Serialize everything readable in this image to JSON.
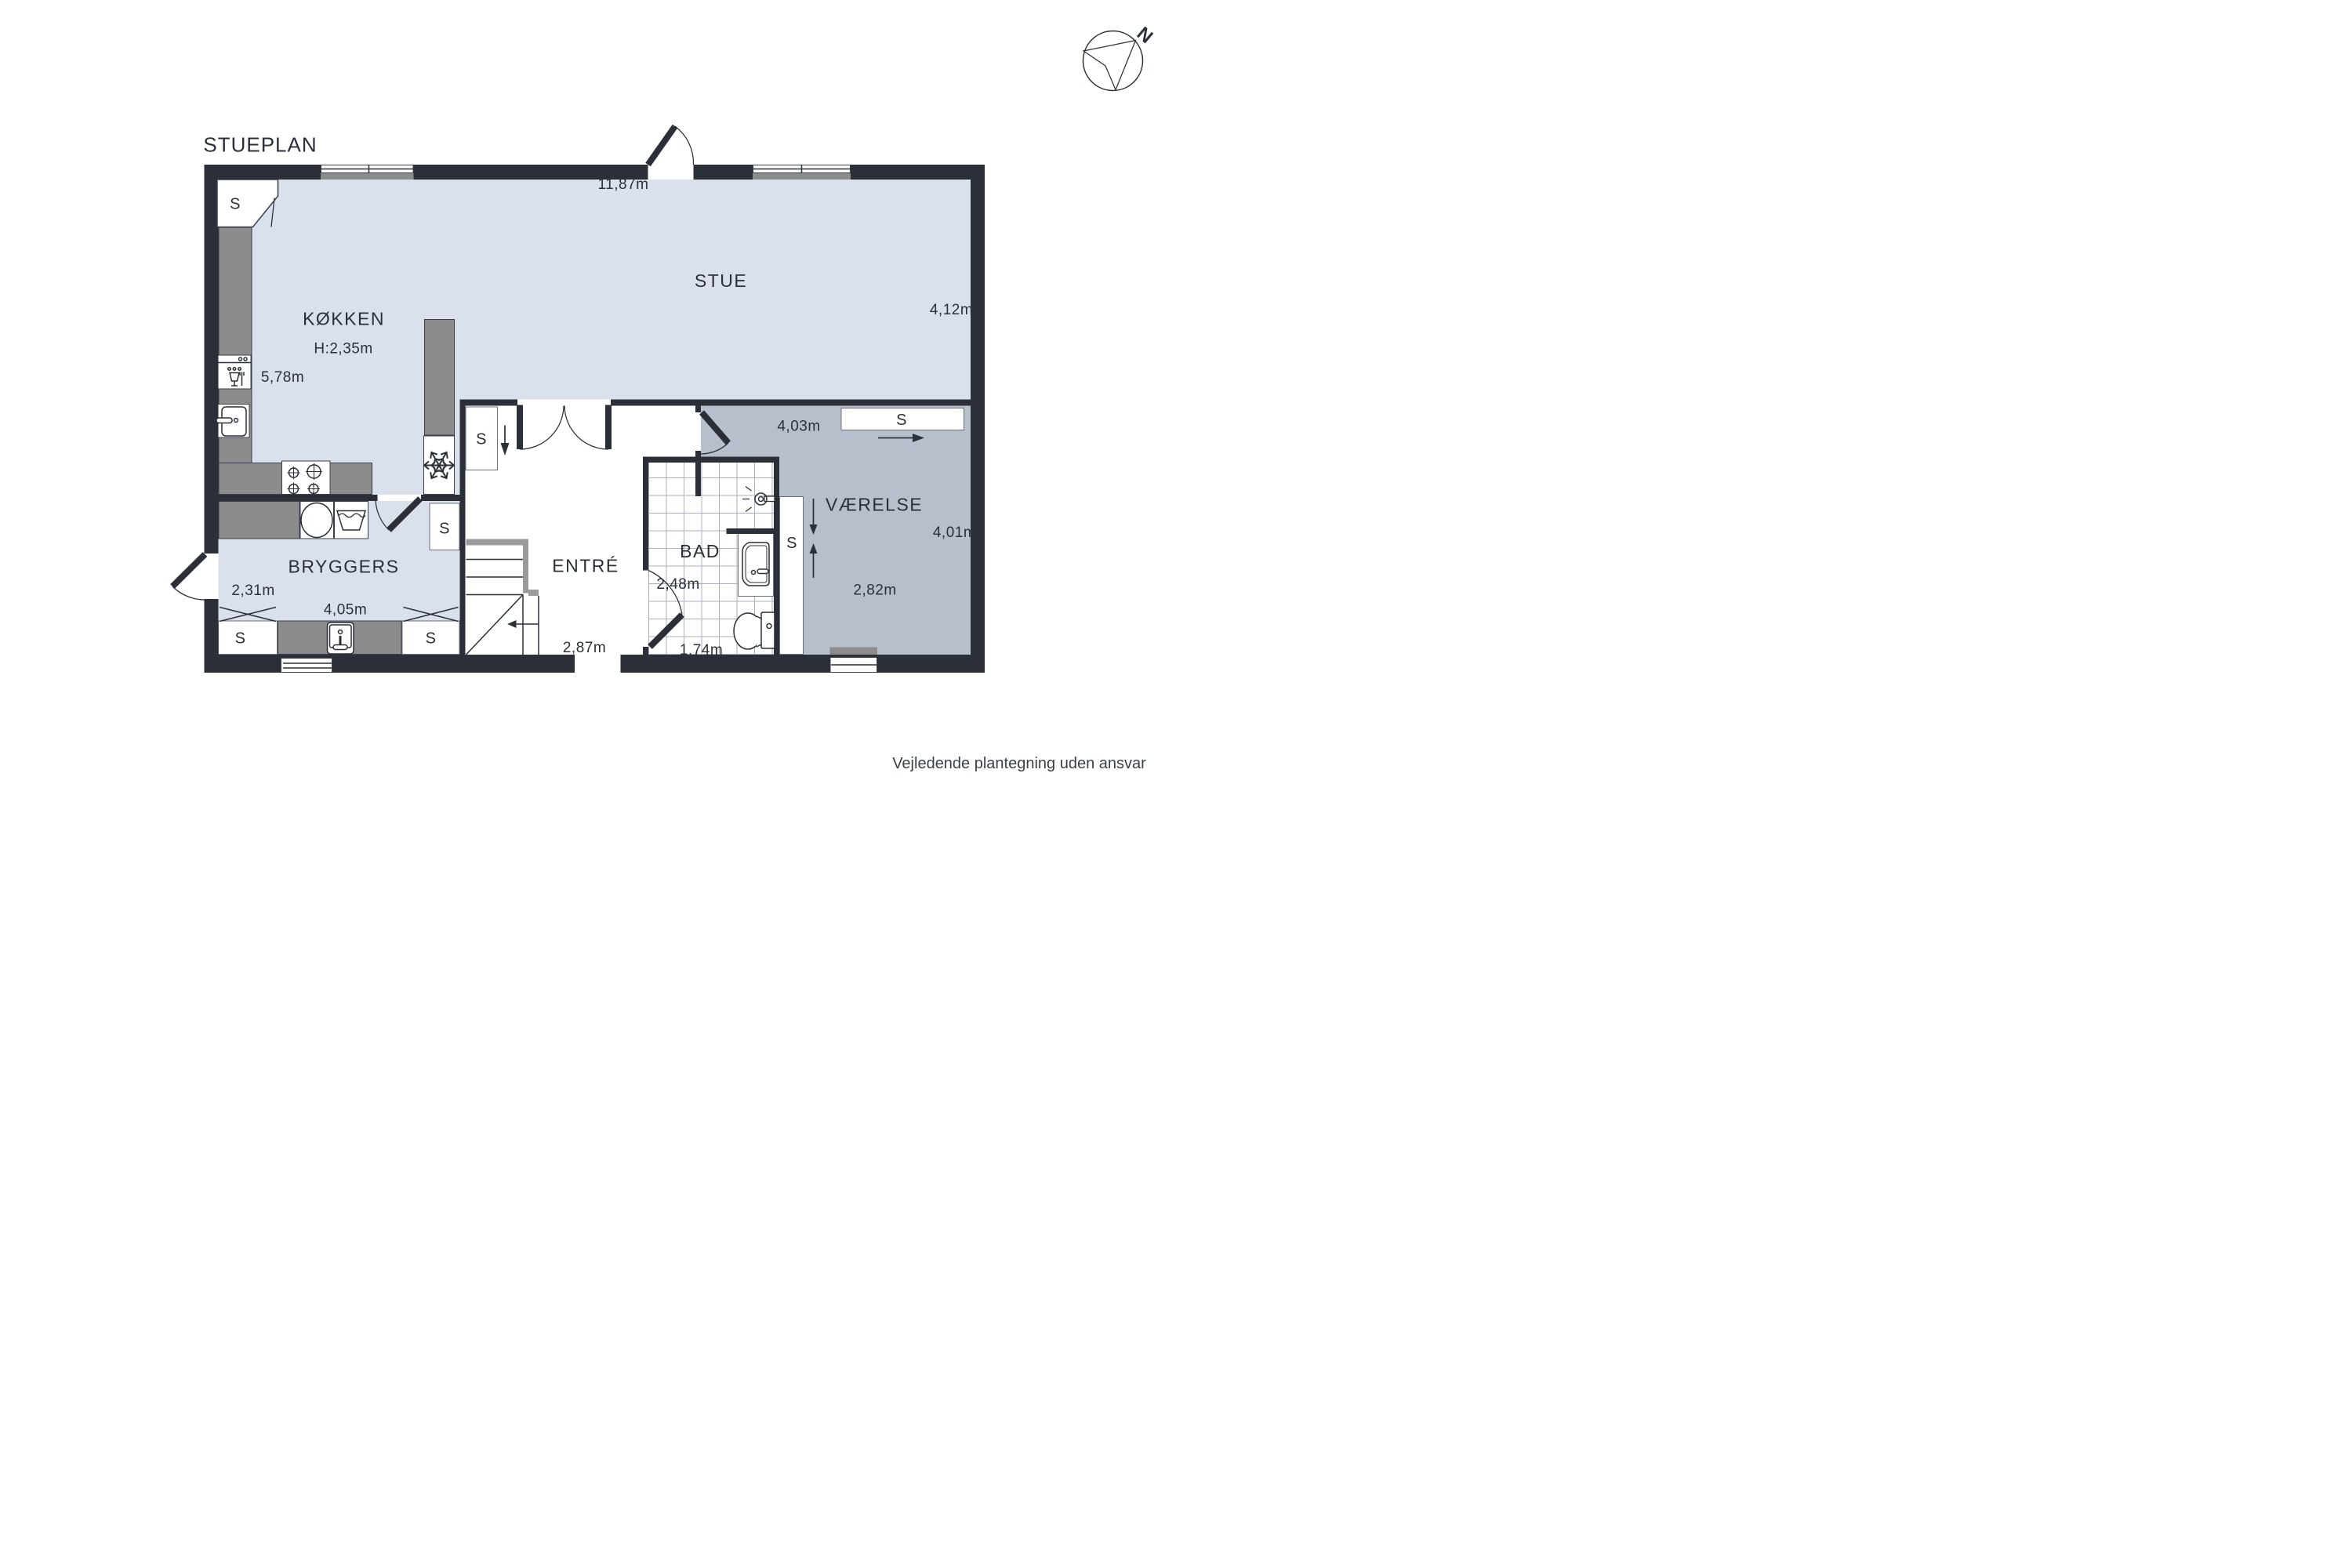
{
  "title": "STUEPLAN",
  "disclaimer": "Vejledende plantegning uden ansvar",
  "compass": {
    "north_label": "N"
  },
  "labels": {
    "closet": "S"
  },
  "rooms": {
    "stue": {
      "name": "STUE",
      "width": "11,87m",
      "depth": "4,12m"
    },
    "kokken": {
      "name": "KØKKEN",
      "ceiling_height": "H:2,35m",
      "width": "5,78m"
    },
    "bryggers": {
      "name": "BRYGGERS",
      "depth": "2,31m",
      "width": "4,05m"
    },
    "entre": {
      "name": "ENTRÉ",
      "width": "2,87m"
    },
    "bad": {
      "name": "BAD",
      "depth": "2,48m",
      "width": "1,74m"
    },
    "vaerelse": {
      "name": "VÆRELSE",
      "top_width": "4,03m",
      "depth": "4,01m",
      "bottom_width": "2,82m"
    }
  },
  "colors": {
    "wall": "#2b2f38",
    "floor": "#dbe1ec",
    "roomgray": "#b8bfcc",
    "counter": "#8c8c8c",
    "rail": "#9b9b9b",
    "text": "#2b2f38"
  }
}
